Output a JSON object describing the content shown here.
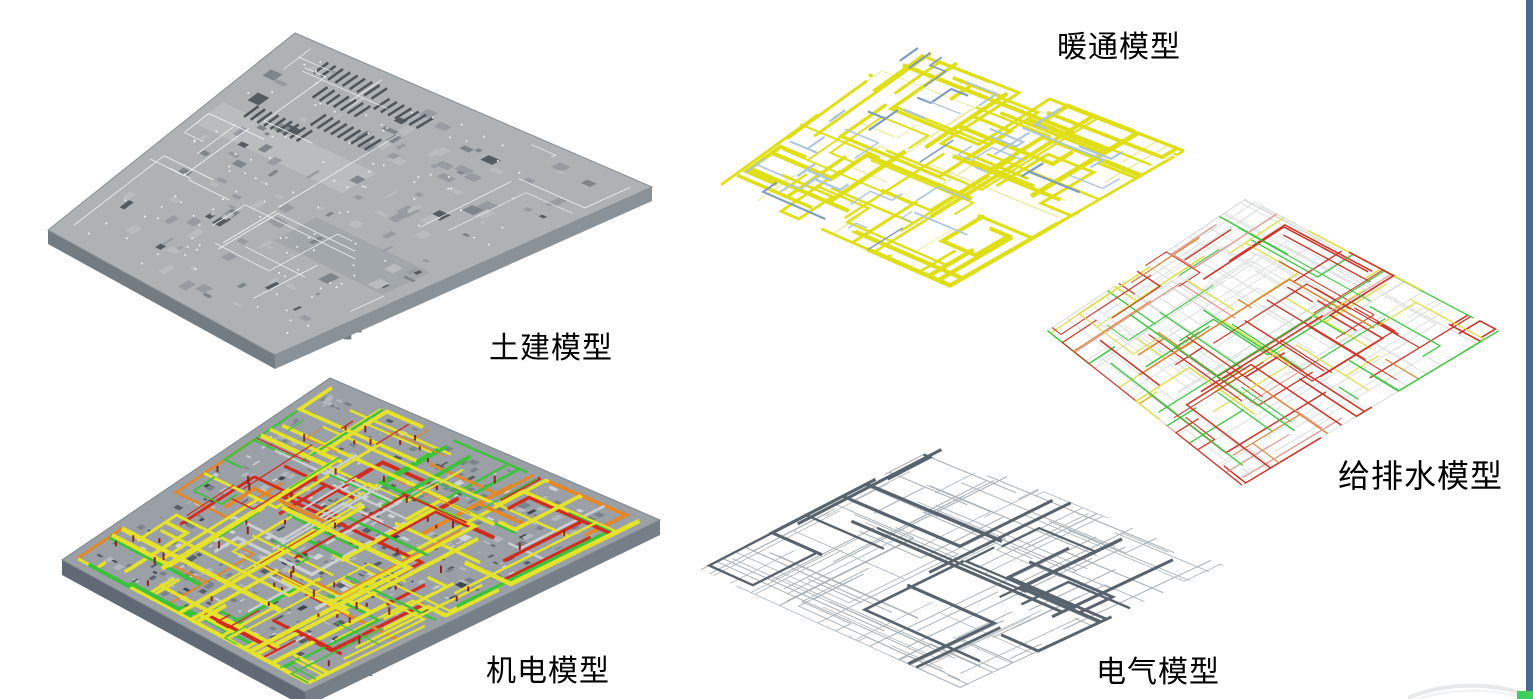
{
  "page": {
    "background": "#ffffff",
    "right_border_color": "#4a6a8f",
    "corner_accent_color": "#3ecf5f",
    "swoosh_color": "#e6e8ea"
  },
  "models": {
    "civil": {
      "label": "土建模型",
      "roof_color": "#aeb2b5",
      "edge_color": "#888f94",
      "side_colors": [
        "#8a9297",
        "#747c82"
      ],
      "detail_colors": [
        "#969ca1",
        "#b8bcbf",
        "#7e868c",
        "#545c62"
      ],
      "marking_color": "#f0f2f3",
      "dot_color": "#eef0f1",
      "vent_color": "#4e565c",
      "band_color": "#bcc0c2"
    },
    "mep": {
      "label": "机电模型",
      "base_color": "#9aa0a5",
      "edge_color": "#7d858c",
      "side_colors": [
        "#767f88",
        "#606974"
      ],
      "pipe_colors": {
        "yellow": "#e4e22a",
        "red": "#d02c20",
        "green": "#3dc23d",
        "orange": "#e2882a",
        "light": "#ccd0d3"
      },
      "tick_color": "#8f221c",
      "detail_colors": [
        "#7b838a",
        "#b2b8bc",
        "#cfd3d6",
        "#565e66",
        "#3e464e"
      ]
    },
    "hvac": {
      "label": "暖通模型",
      "duct_color": "#e0de16",
      "duct_light_color": "#ececa0",
      "fitting_color": "#aec6dd",
      "fitting_dark_color": "#7e9cc0"
    },
    "plumbing": {
      "label": "给排水模型",
      "frame_color": "#d8dadb",
      "pipe_colors": {
        "red": "#cf3528",
        "pink": "#e49b93",
        "green": "#3cc940",
        "yellow": "#e0de3e",
        "orange": "#df8430"
      }
    },
    "electrical": {
      "label": "电气模型",
      "wire_color": "#a9b1b8",
      "tray_color": "#59636e"
    }
  }
}
